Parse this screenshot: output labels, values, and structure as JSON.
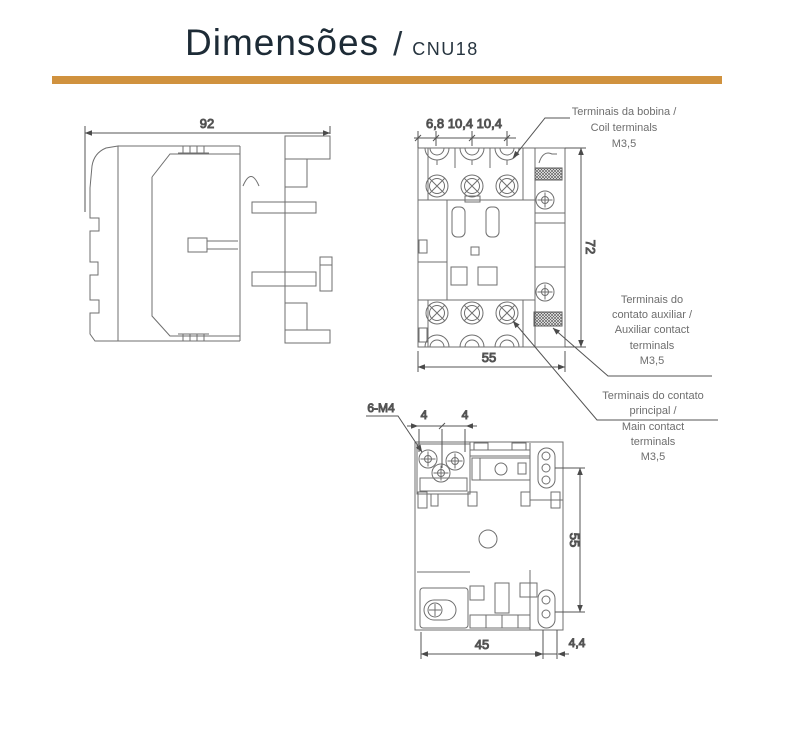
{
  "header": {
    "title": "Dimensões",
    "separator": "/",
    "model": "CNU18",
    "accent_color": "#d0923e"
  },
  "dimensions": {
    "side_width": "92",
    "front_pitch": "6,8 10,4 10,4",
    "front_height": "72",
    "front_width": "55",
    "mount_label": "6-M4",
    "mount_pitch_left": "4",
    "mount_pitch_right": "4",
    "mount_height": "55",
    "mount_width": "45",
    "mount_offset": "4,4"
  },
  "annotations": {
    "coil": {
      "lines": [
        "Terminais da bobina /",
        "Coil terminals",
        "M3,5"
      ]
    },
    "auxiliary": {
      "lines": [
        "Terminais do",
        "contato auxiliar /",
        "Auxiliar contact",
        "terminals",
        "M3,5"
      ]
    },
    "main": {
      "lines": [
        "Terminais do contato",
        "principal /",
        "Main contact",
        "terminals",
        "M3,5"
      ]
    }
  }
}
